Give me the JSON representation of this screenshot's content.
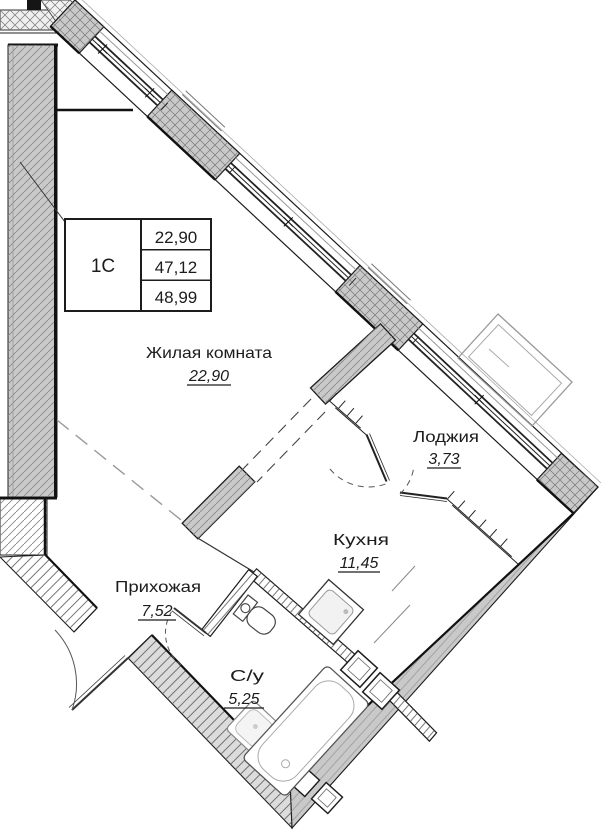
{
  "plan": {
    "type": "apartment-floor-plan",
    "unit_label": "1С",
    "unit_info": {
      "living_area": "22,90",
      "area_without_loggia": "47,12",
      "total_area": "48,99"
    },
    "rooms": [
      {
        "id": "living",
        "name": "Жилая комната",
        "area": "22,90"
      },
      {
        "id": "loggia",
        "name": "Лоджия",
        "area": "3,73"
      },
      {
        "id": "kitchen",
        "name": "Кухня",
        "area": "11,45"
      },
      {
        "id": "hall",
        "name": "Прихожая",
        "area": "7,52"
      },
      {
        "id": "wc",
        "name": "С/у",
        "area": "5,25"
      }
    ],
    "fixtures": [
      "bathtub",
      "washbasin",
      "toilet",
      "kitchen-sink",
      "vent-shaft",
      "ac-unit-basket"
    ],
    "colors": {
      "background": "#ffffff",
      "wall_fill": "#c9c9c9",
      "wall_fill_light": "#dcdcdc",
      "line": "#1c1c1c",
      "hatch": "#8a8a8a",
      "gray_line": "#9a9a9a"
    }
  }
}
